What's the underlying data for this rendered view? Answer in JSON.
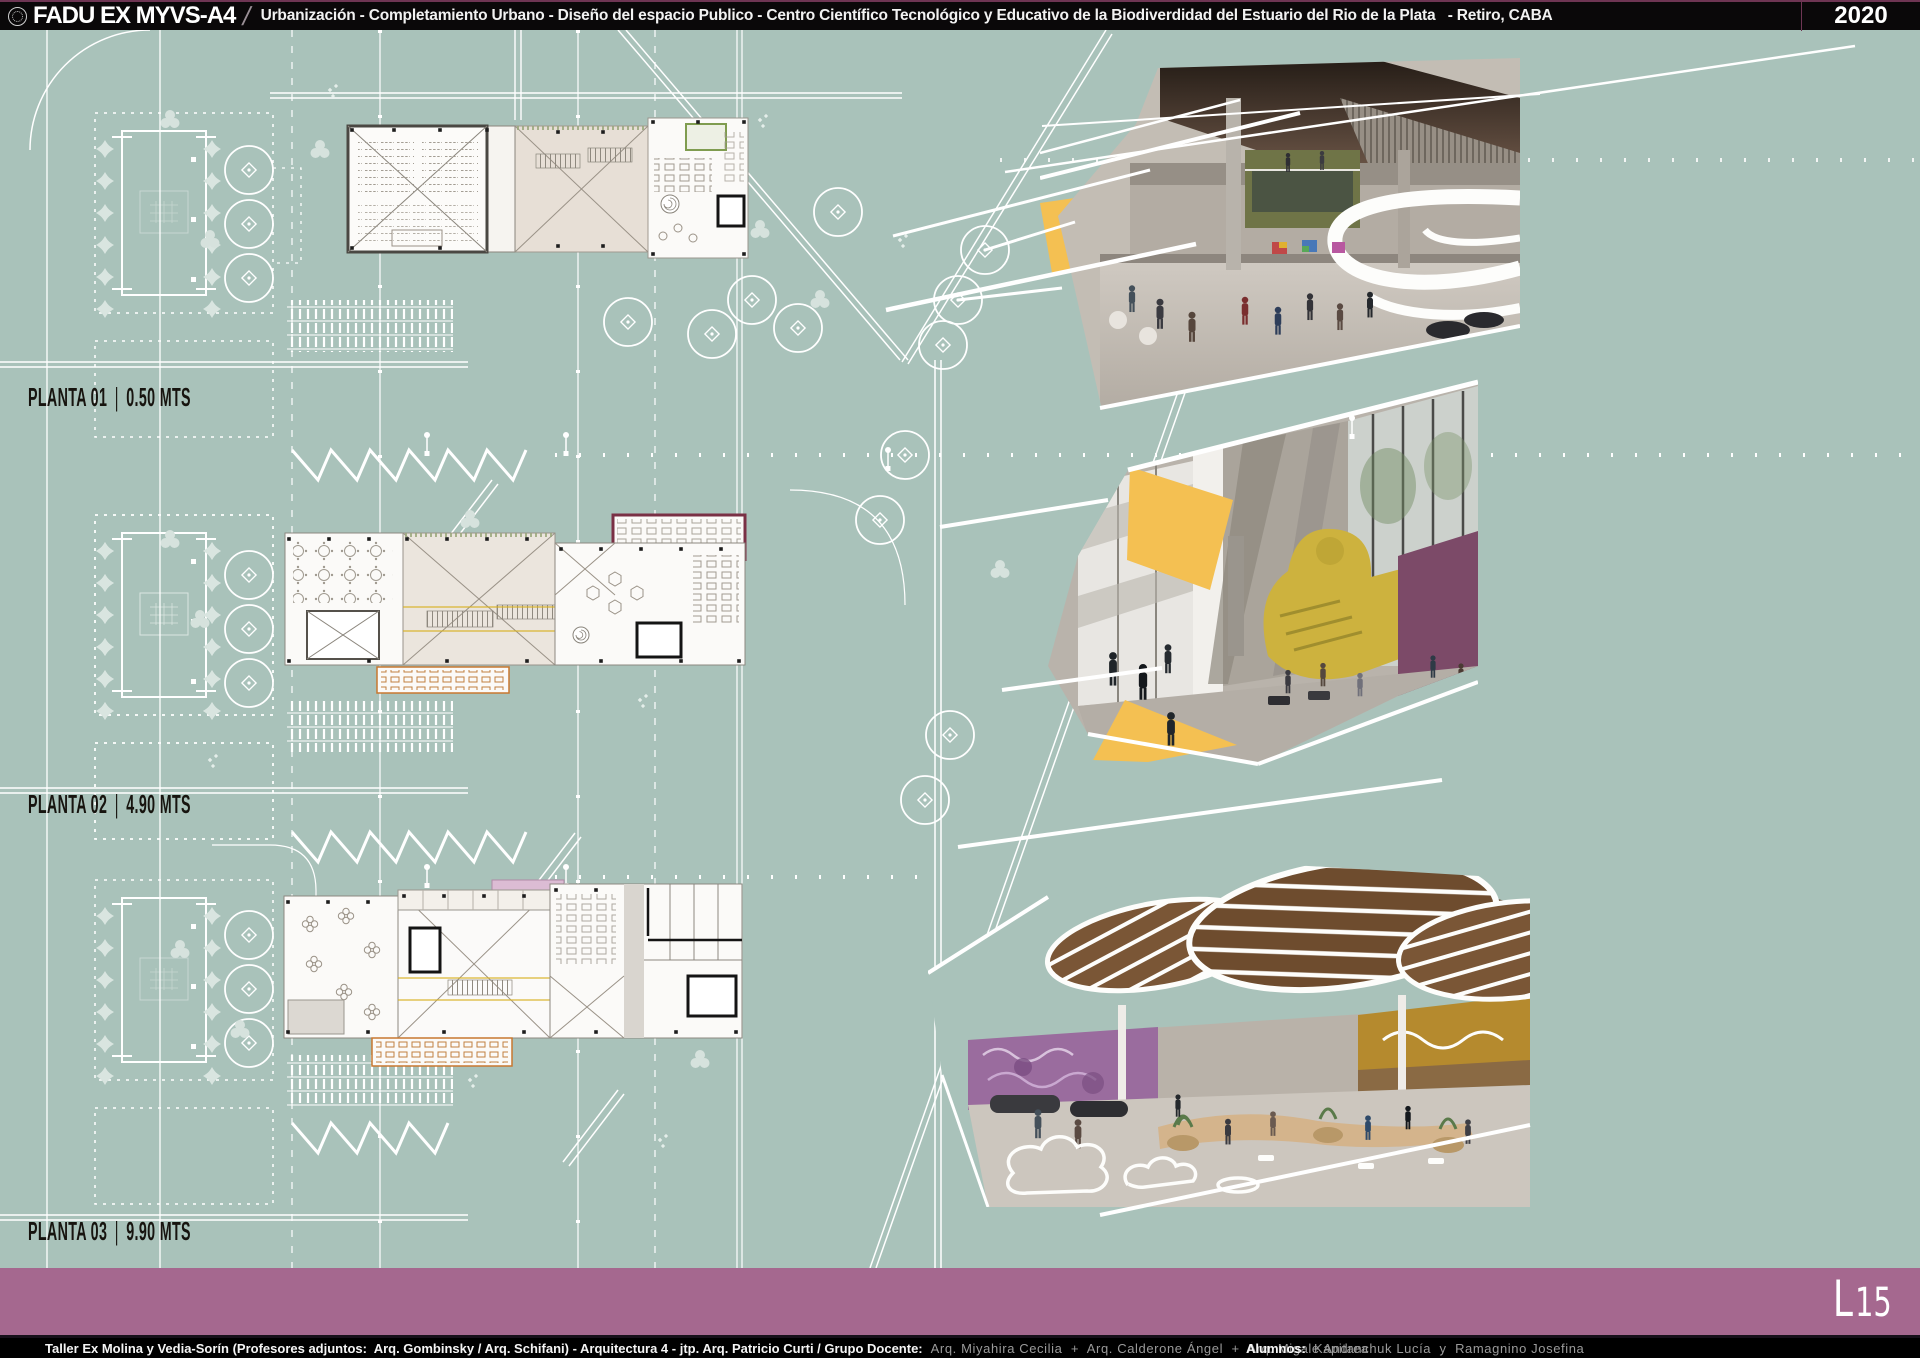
{
  "header": {
    "logo_icon": "uba-crest-icon",
    "brand": "FADU EX MYVS-A4",
    "divider": "/",
    "title": "Urbanización - Completamiento Urbano - Diseño del espacio Publico - Centro Científico Tecnológico y Educativo de la Biodiverdidad del Estuario del Rio de la Plata   - Retiro, CABA",
    "year": "2020"
  },
  "plan_labels": [
    {
      "name": "PLANTA 01",
      "divider": "|",
      "level": "0.50 MTS"
    },
    {
      "name": "PLANTA 02",
      "divider": "|",
      "level": "4.90 MTS"
    },
    {
      "name": "PLANTA 03",
      "divider": "|",
      "level": "9.90 MTS"
    }
  ],
  "sheet_code": {
    "letter": "L",
    "number": "15"
  },
  "footer": {
    "credits_bold": "Taller Ex Molina y Vedia-Sorín (Profesores adjuntos:  Arq. Gombinsky / Arq. Schifani) - Arquitectura 4 - jtp. Arq. Patricio Curti / Grupo Docente:",
    "credits_names": "Arq. Miyahira Cecilia  +  Arq. Calderone Ángel  +  Arq. Migale Andrea",
    "students_label": "Alumnos:",
    "students_names": "Kapitanchuk Lucía  y  Ramagnino Josefina"
  },
  "palette": {
    "board_background": "#a9c2ba",
    "linework": "#ffffff",
    "header_bar": "#0a0809",
    "accent_bar_mauve": "#a5688f",
    "accent_yellow": "#f4c052",
    "accent_orange": "#c87830",
    "accent_maroon": "#7a3045",
    "render_purple": "#7c4a68",
    "render_olive": "#6f7447",
    "render_wood": "#7a5a3a",
    "label_ink": "#17140f",
    "footer_names_grey": "#9a9a9a"
  }
}
